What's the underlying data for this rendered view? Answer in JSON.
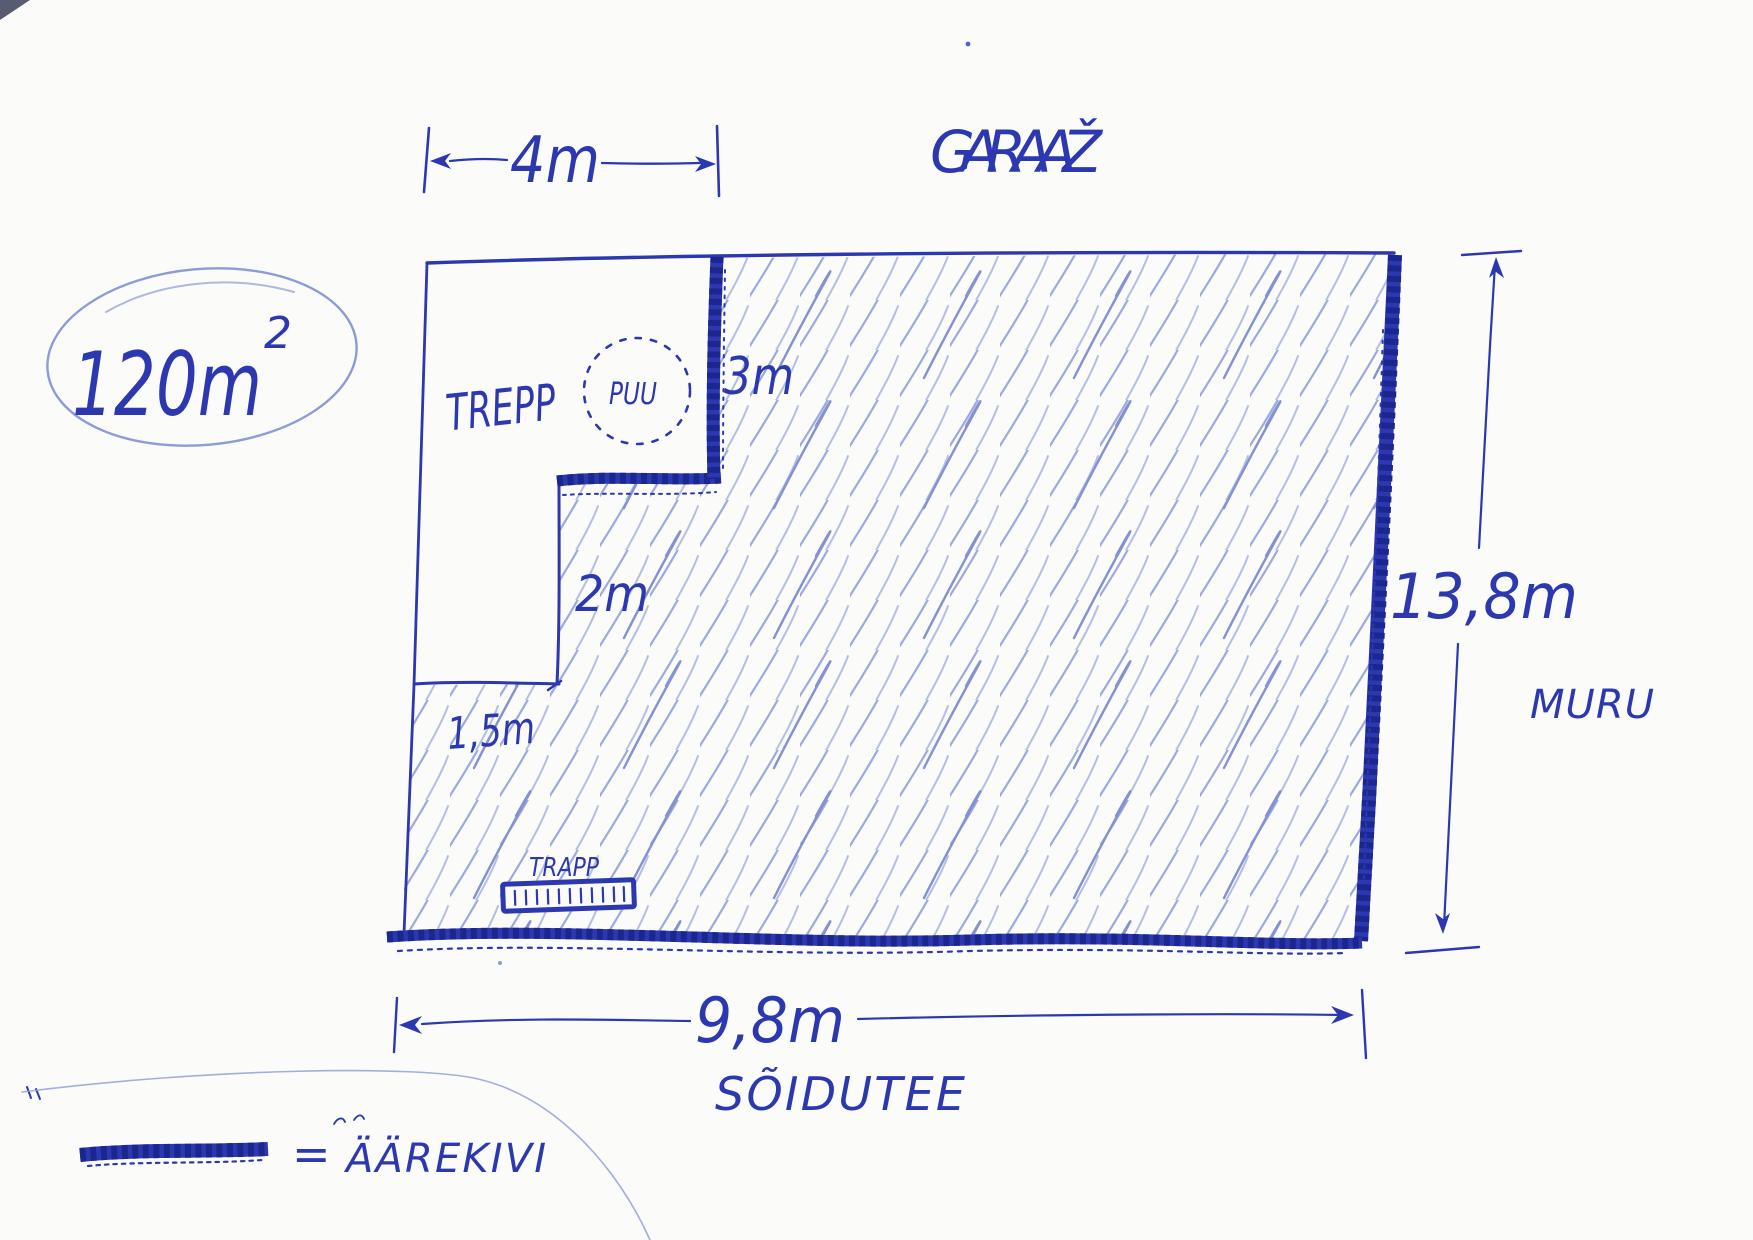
{
  "plan": {
    "area": {
      "value": "120m",
      "exponent": "2"
    },
    "labels": {
      "garage": "GARAAŽ",
      "stairs": "TREPP",
      "tree": "PUU",
      "lawn": "MURU",
      "driveway": "SÕIDUTEE",
      "drain": "TRAPP"
    },
    "dimensions": {
      "stairs_width": "4m",
      "curb_side": "3m",
      "step_side": "2m",
      "step_bottom": "1,5m",
      "plot_height": "13,8m",
      "plot_width": "9,8m"
    },
    "legend": {
      "equals": "=",
      "curb": "ÄÄREKIVI"
    },
    "colors": {
      "pen": "#2c38b0",
      "pen_dark": "#1b278f",
      "pen_light": "#8d9bd6",
      "hatch": "#9caadf",
      "hatch_dark": "#8492d2",
      "paper": "#fbfbf9"
    }
  }
}
